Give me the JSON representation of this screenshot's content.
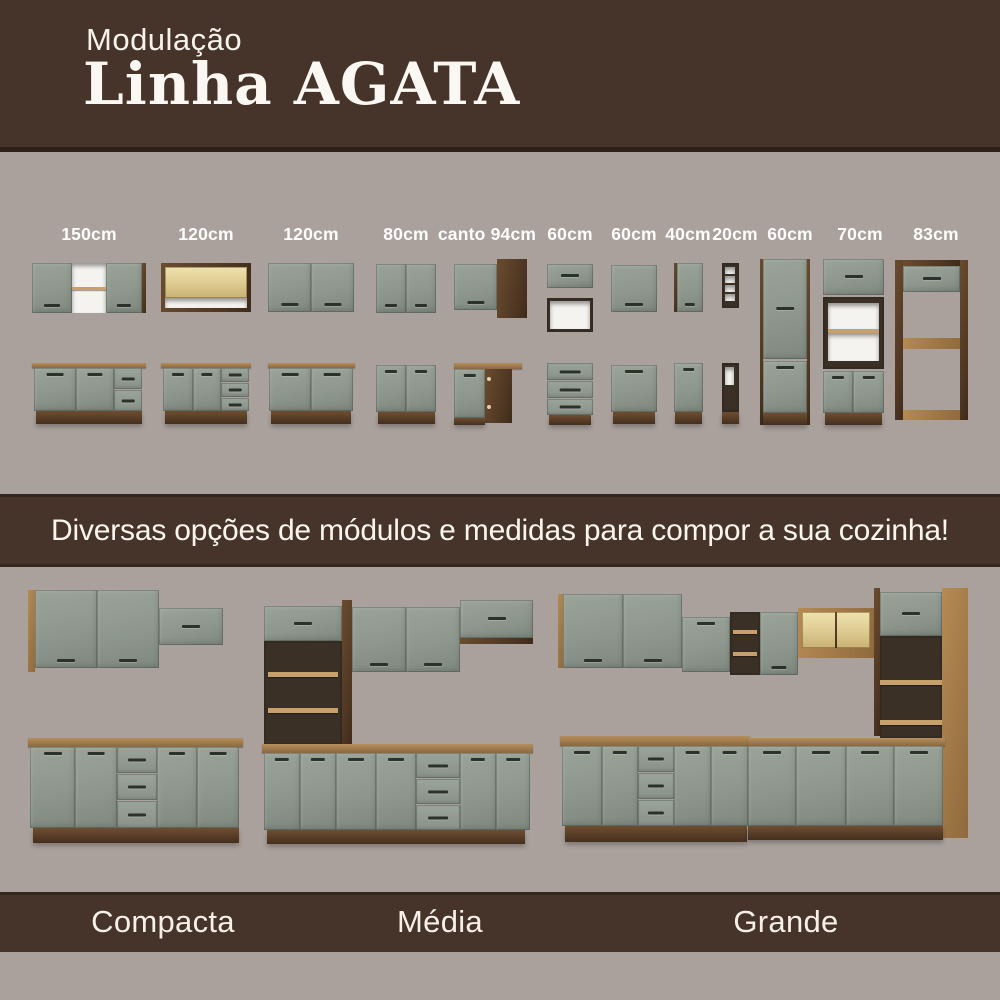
{
  "header": {
    "eyebrow": "Modulação",
    "title": "Linha AGATA"
  },
  "modules": {
    "labels": [
      "150cm",
      "120cm",
      "120cm",
      "80cm",
      "canto 94cm",
      "60cm",
      "60cm",
      "40cm",
      "20cm",
      "60cm",
      "70cm",
      "83cm"
    ]
  },
  "banner": {
    "text": "Diversas opções de módulos e medidas para compor a sua cozinha!"
  },
  "footer": {
    "labels": [
      "Compacta",
      "Média",
      "Grande"
    ]
  },
  "colors": {
    "background": "#aba19c",
    "brown": "#46342a",
    "cabinet_sage": "#8e978d",
    "wood_light": "#a9824f",
    "wood_dark": "#553b25",
    "handle": "#2c312c",
    "glass_glow": "#e0cf96",
    "text": "#ffffff"
  }
}
